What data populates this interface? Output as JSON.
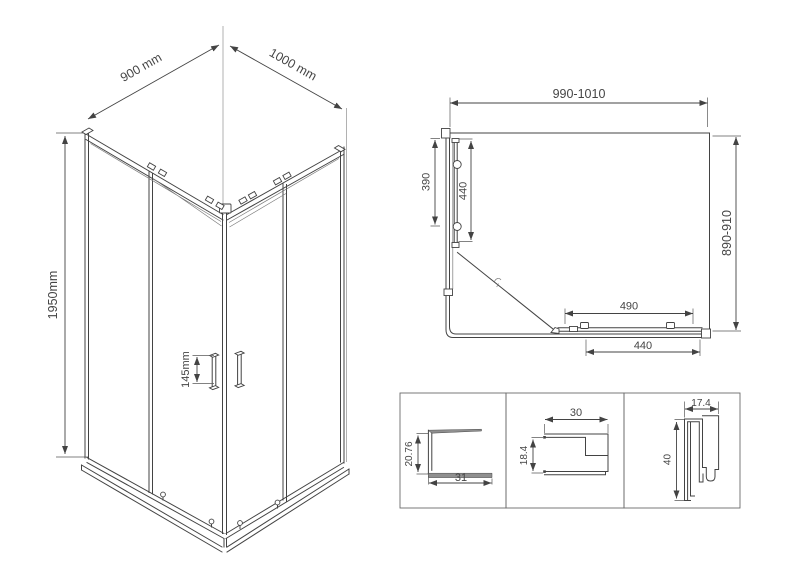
{
  "colors": {
    "background": "#ffffff",
    "line": "#434343",
    "text": "#454545",
    "detail_box_border": "#6a6a6a"
  },
  "isometric_view": {
    "width_label": "900 mm",
    "depth_label": "1000 mm",
    "height_label": "1950mm",
    "handle_label": "145mm"
  },
  "plan_view": {
    "width_range_label": "990-1010",
    "depth_range_label": "890-910",
    "side_panel_label": "390",
    "side_door_label": "440",
    "front_door_label": "490",
    "front_panel_label": "440"
  },
  "profile_details": [
    {
      "height_label": "20.76",
      "width_label": "31"
    },
    {
      "width_label": "30",
      "height_label": "18.4"
    },
    {
      "width_label": "17.4",
      "height_label": "40"
    }
  ]
}
